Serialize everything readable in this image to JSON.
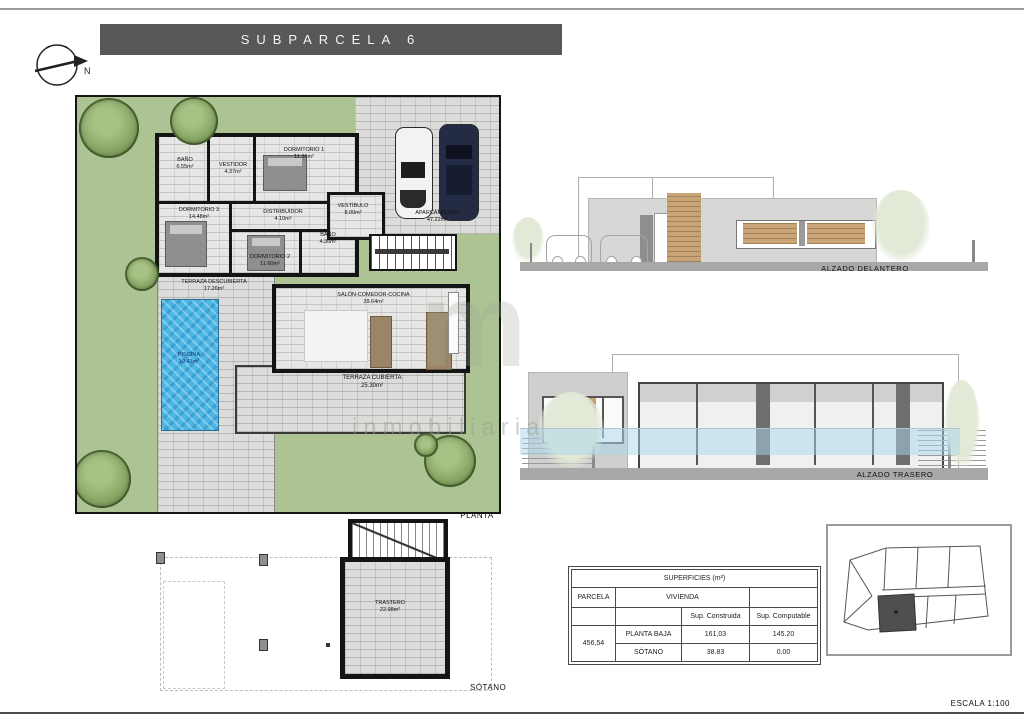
{
  "title": "SUBPARCELA 6",
  "north": {
    "label": "N"
  },
  "plan": {
    "label": "PLANTA"
  },
  "rooms": {
    "bano1": {
      "name": "BAÑO",
      "area": "6.55m²"
    },
    "vestidor": {
      "name": "VESTIDOR",
      "area": "4.37m²"
    },
    "dorm1": {
      "name": "DORMITORIO 1",
      "area": "11.36m²"
    },
    "dorm3": {
      "name": "DORMITORIO 3",
      "area": "14.48m²"
    },
    "distribuidor": {
      "name": "DISTRIBUIDOR",
      "area": "4.10m²"
    },
    "vestibulo": {
      "name": "VESTÍBULO",
      "area": "8.00m²"
    },
    "bano2": {
      "name": "BAÑO",
      "area": "4.36m²"
    },
    "dorm2": {
      "name": "DORMITORIO 2",
      "area": "11.60m²"
    },
    "terraza_desc": {
      "name": "TERRAZA DESCUBIERTA",
      "area": "17.26m²"
    },
    "salon": {
      "name": "SALÓN-COMEDOR-COCINA",
      "area": "39.64m²"
    },
    "piscina": {
      "name": "PISCINA",
      "area": "19.43m²"
    },
    "terraza_cub": {
      "name": "TERRAZA CUBIERTA",
      "area": "25.30m²"
    },
    "aparcamiento": {
      "name": "APARCAMIENTO",
      "area": "47.22m²"
    }
  },
  "elevations": {
    "front": "ALZADO DELANTERO",
    "rear": "ALZADO TRASERO"
  },
  "basement": {
    "label": "SÓTANO",
    "trastero": {
      "name": "TRASTERO",
      "area": "22.98m²"
    }
  },
  "table": {
    "title": "SUPERFICIES (m²)",
    "col_parcela": "PARCELA",
    "col_vivienda": "VIVIENDA",
    "sub_construida": "Sup. Construida",
    "sub_computable": "Sup. Computable",
    "parcela_value": "456,54",
    "rows": [
      {
        "name": "PLANTA BAJA",
        "construida": "161,03",
        "computable": "145.20"
      },
      {
        "name": "SÓTANO",
        "construida": "38.83",
        "computable": "0.00"
      }
    ]
  },
  "scale": "ESCALA 1:100",
  "watermark": {
    "logo": "m",
    "text": "inmobiliaria"
  },
  "colors": {
    "title_bg": "#58585a",
    "garden_green": "#aec394",
    "pool_blue": "#4db6e3",
    "paving": "#dcdcda",
    "wall": "#141414"
  }
}
